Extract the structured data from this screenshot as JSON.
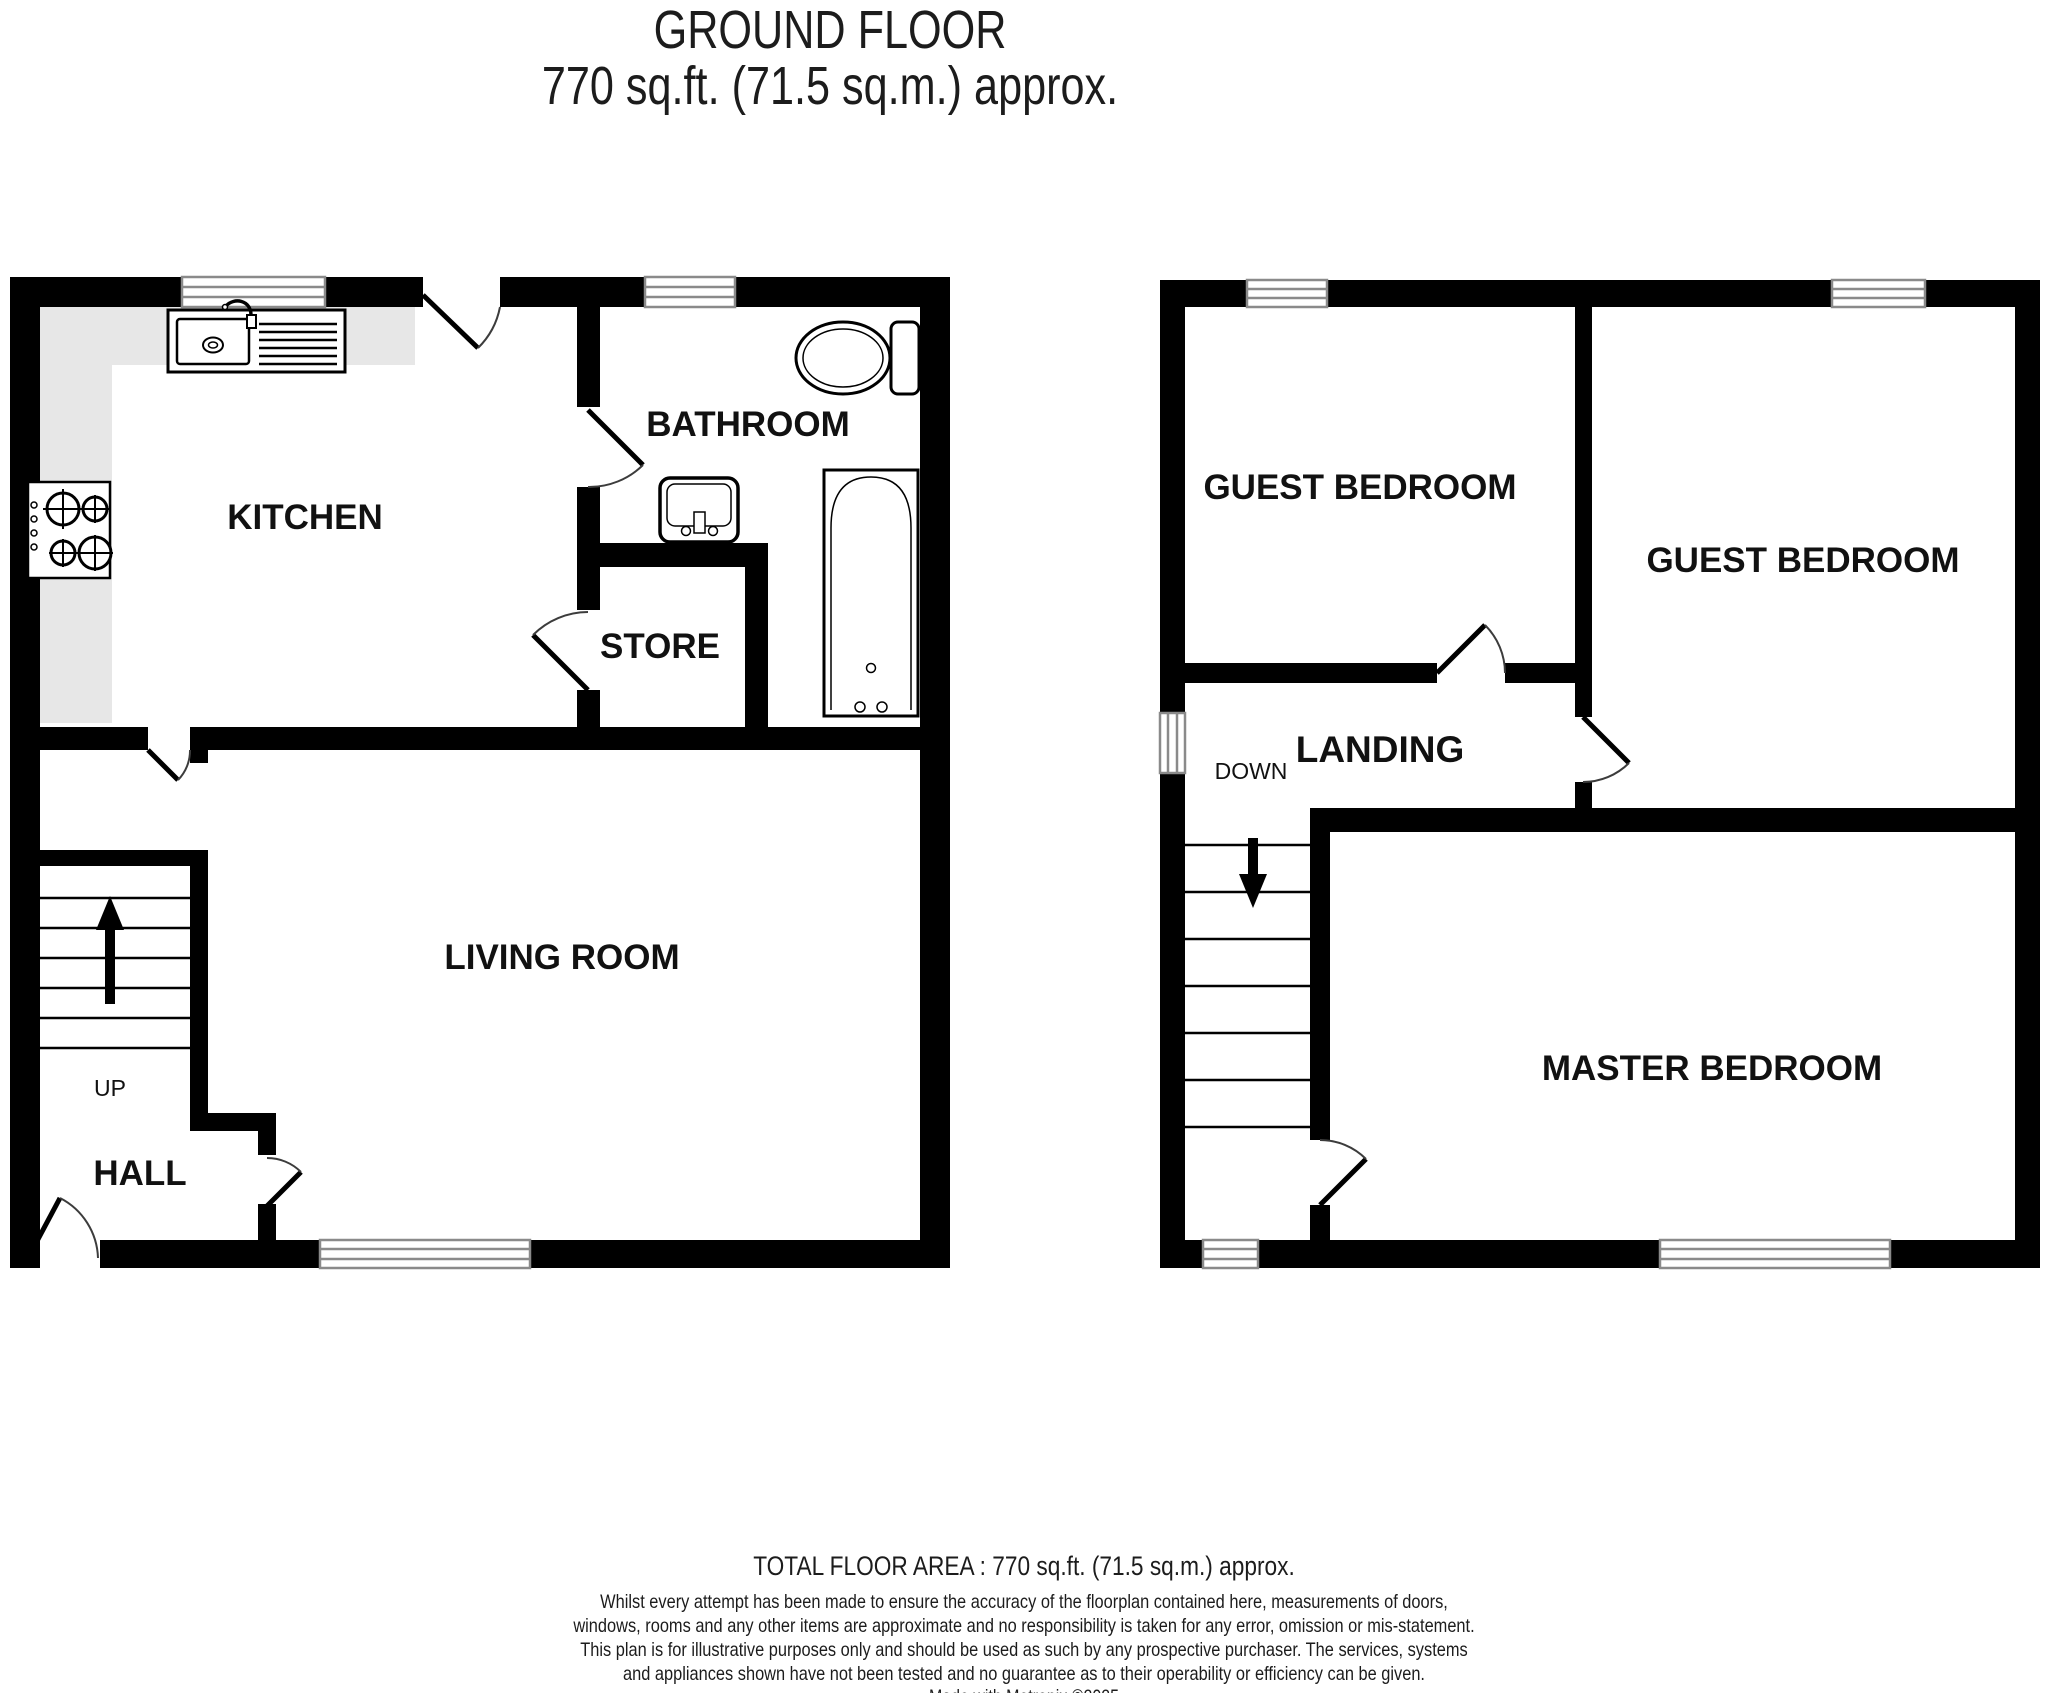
{
  "title": {
    "line1": "GROUND FLOOR",
    "line2": "770 sq.ft. (71.5 sq.m.) approx."
  },
  "plans": {
    "ground_floor": {
      "rooms": {
        "kitchen": "KITCHEN",
        "bathroom": "BATHROOM",
        "store": "STORE",
        "living_room": "LIVING ROOM",
        "hall": "HALL"
      },
      "stairs_label": "UP",
      "fixtures": [
        "kitchen-sink",
        "hob",
        "toilet",
        "bathroom-sink",
        "bathtub"
      ],
      "windows": 3,
      "doors": 6
    },
    "first_floor": {
      "rooms": {
        "guest_bedroom_1": "GUEST BEDROOM",
        "guest_bedroom_2": "GUEST BEDROOM",
        "landing": "LANDING",
        "master_bedroom": "MASTER BEDROOM"
      },
      "stairs_label": "DOWN",
      "fixtures": [],
      "windows": 5,
      "doors": 3
    }
  },
  "footer": {
    "total_area": "TOTAL FLOOR AREA : 770 sq.ft. (71.5 sq.m.) approx.",
    "disclaimer": "Whilst every attempt has been made to ensure the accuracy of the floorplan contained here, measurements of doors, windows, rooms and any other items are approximate and no responsibility is taken for any error, omission or mis-statement. This plan is for illustrative purposes only and should be used as such by any prospective purchaser. The services, systems and appliances shown have not been tested and no guarantee as to their operability or efficiency can be given.",
    "credit": "Made with Metropix ©2025"
  },
  "colors": {
    "wall": "#000000",
    "background": "#ffffff",
    "counter": "#e7e7e7",
    "window_line": "#8a8a8a",
    "text": "#111111"
  }
}
